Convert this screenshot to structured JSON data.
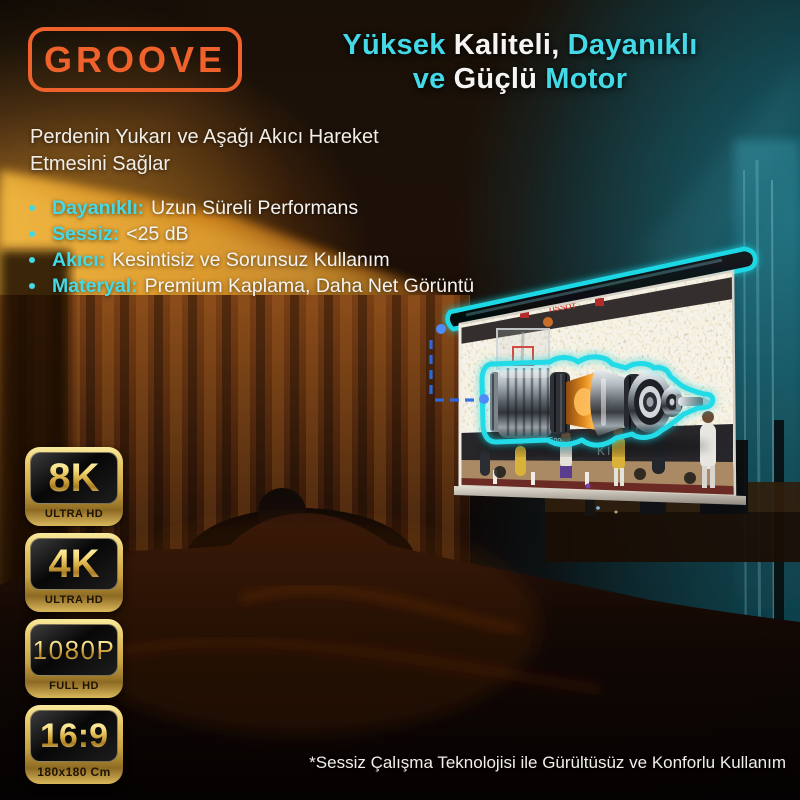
{
  "brand": {
    "name": "GROOVE",
    "color": "#F0622C"
  },
  "header": {
    "title_line1_words": [
      "Yüksek",
      "Kaliteli,",
      "Dayanıklı"
    ],
    "title_line2_words": [
      "ve",
      "Güçlü",
      "Motor"
    ]
  },
  "subtitle": {
    "line1": "Perdenin Yukarı ve Aşağı Akıcı Hareket",
    "line2": "Etmesini Sağlar"
  },
  "features": [
    {
      "label": "Dayanıklı:",
      "text": "Uzun Süreli Performans"
    },
    {
      "label": "Sessiz:",
      "text": "<25 dB"
    },
    {
      "label": "Akıcı:",
      "text": "Kesintisiz ve Sorunsuz Kullanım"
    },
    {
      "label": "Materyal:",
      "text": "Premium Kaplama, Daha Net Görüntü"
    }
  ],
  "badges": [
    {
      "value": "8K",
      "label": "ULTRA HD"
    },
    {
      "value": "4K",
      "label": "ULTRA HD"
    },
    {
      "value": "1080P",
      "label": "FULL HD"
    },
    {
      "value": "16:9",
      "label": "180x180 Cm"
    }
  ],
  "footnote": "*Sessiz Çalışma Teknolojisi ile Gürültüsüz ve Konforlu Kullanım",
  "screen_photo_texts": {
    "banner": "TISSOT",
    "courtside": "KIA",
    "courtside2": "Google"
  },
  "colors": {
    "accent_cyan": "#43D9E6",
    "outline_cyan": "#1FD8E4",
    "brand_orange": "#F0622C",
    "badge_gold": "#E9C766",
    "connector_blue": "#2D6BE4",
    "connector_dot_blue": "#4F8BF7"
  }
}
